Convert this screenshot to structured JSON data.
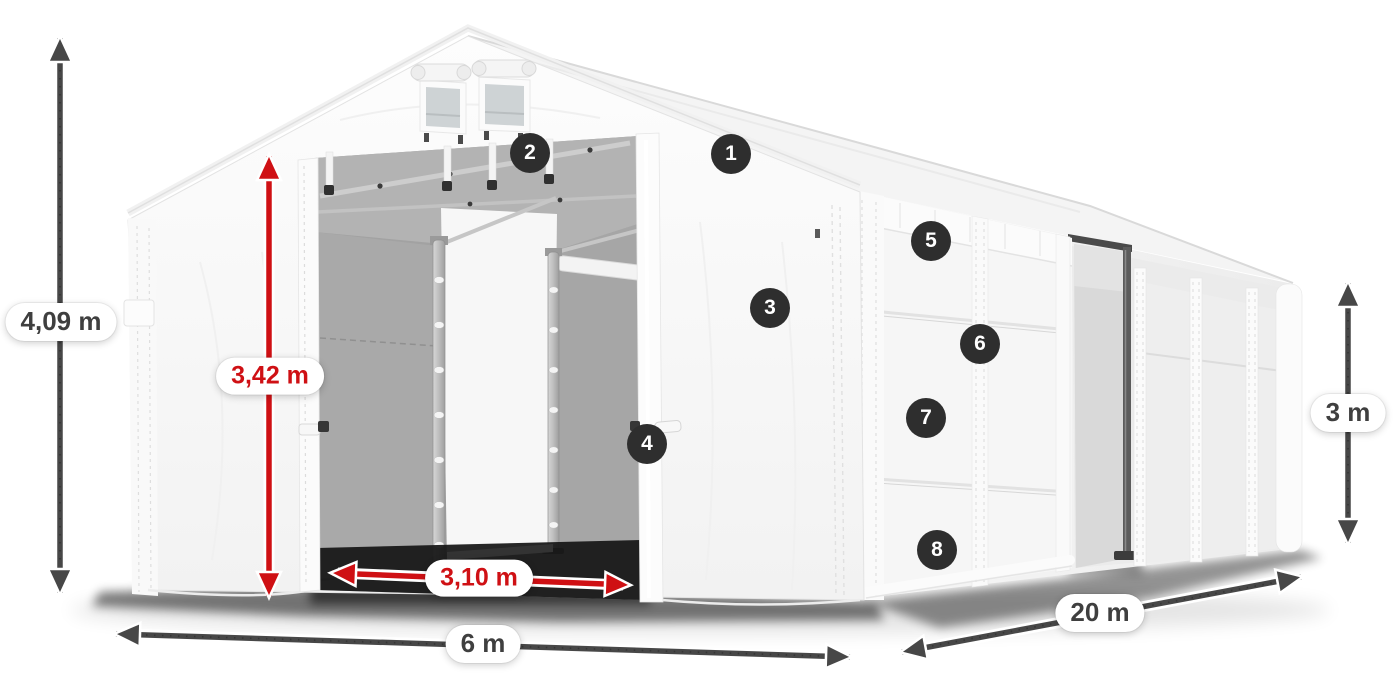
{
  "diagram": {
    "description": "Storage tent illustration with dimension callouts",
    "dimensions": {
      "total_height": "4,09 m",
      "door_height": "3,42 m",
      "door_width": "3,10 m",
      "front_width": "6 m",
      "length": "20 m",
      "side_wall_height": "3 m"
    },
    "callouts": [
      "1",
      "2",
      "3",
      "4",
      "5",
      "6",
      "7",
      "8"
    ]
  },
  "colors": {
    "accent_red": "#cf1014",
    "arrow_dark": "#474747",
    "badge_bg": "#2e2e2e",
    "pill_text": "#3f3f3f",
    "page_bg": "#ffffff"
  }
}
